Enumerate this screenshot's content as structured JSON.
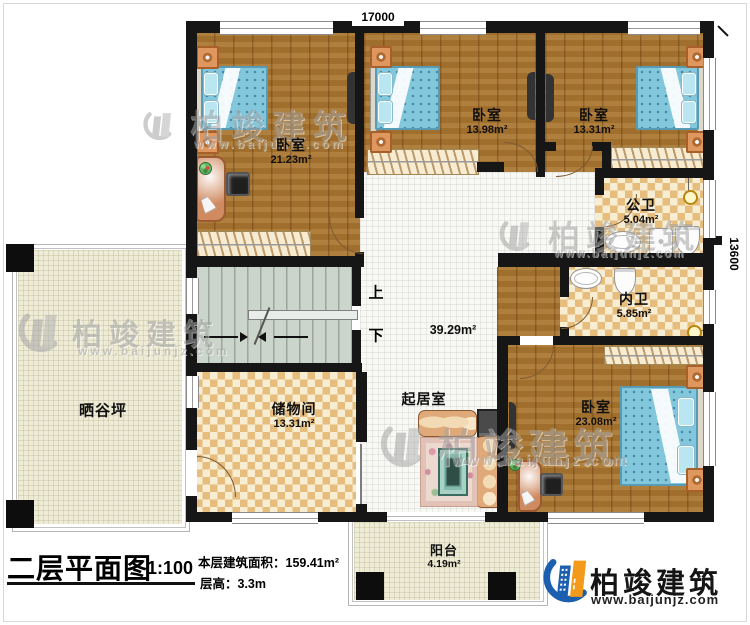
{
  "dims": {
    "top": "17000",
    "right": "13600"
  },
  "rooms": {
    "bedroom1": {
      "name": "卧室",
      "area": "21.23m²"
    },
    "bedroom2": {
      "name": "卧室",
      "area": "13.98m²"
    },
    "bedroom3": {
      "name": "卧室",
      "area": "13.31m²"
    },
    "public_bath": {
      "name": "公卫",
      "area": "5.04m²"
    },
    "private_bath": {
      "name": "内卫",
      "area": "5.85m²"
    },
    "bedroom4": {
      "name": "卧室",
      "area": "23.08m²"
    },
    "living": {
      "name": "起居室",
      "area": "39.29m²"
    },
    "storage": {
      "name": "储物间",
      "area": "13.31m²"
    },
    "terrace": {
      "name": "晒谷坪"
    },
    "balcony": {
      "name": "阳台",
      "area": "4.19m²"
    }
  },
  "stairs": {
    "up": "上",
    "down": "下"
  },
  "title_block": {
    "title": "二层平面图",
    "scale": "1:100",
    "floor_area": "本层建筑面积：159.41m²",
    "floor_height": "层高：3.3m"
  },
  "brand": {
    "name": "柏竣建筑",
    "url": "www.baijunjz.com"
  },
  "colors": {
    "accent_blue": "#1c5fae",
    "accent_orange": "#f39a1a",
    "wall": "#161616"
  }
}
